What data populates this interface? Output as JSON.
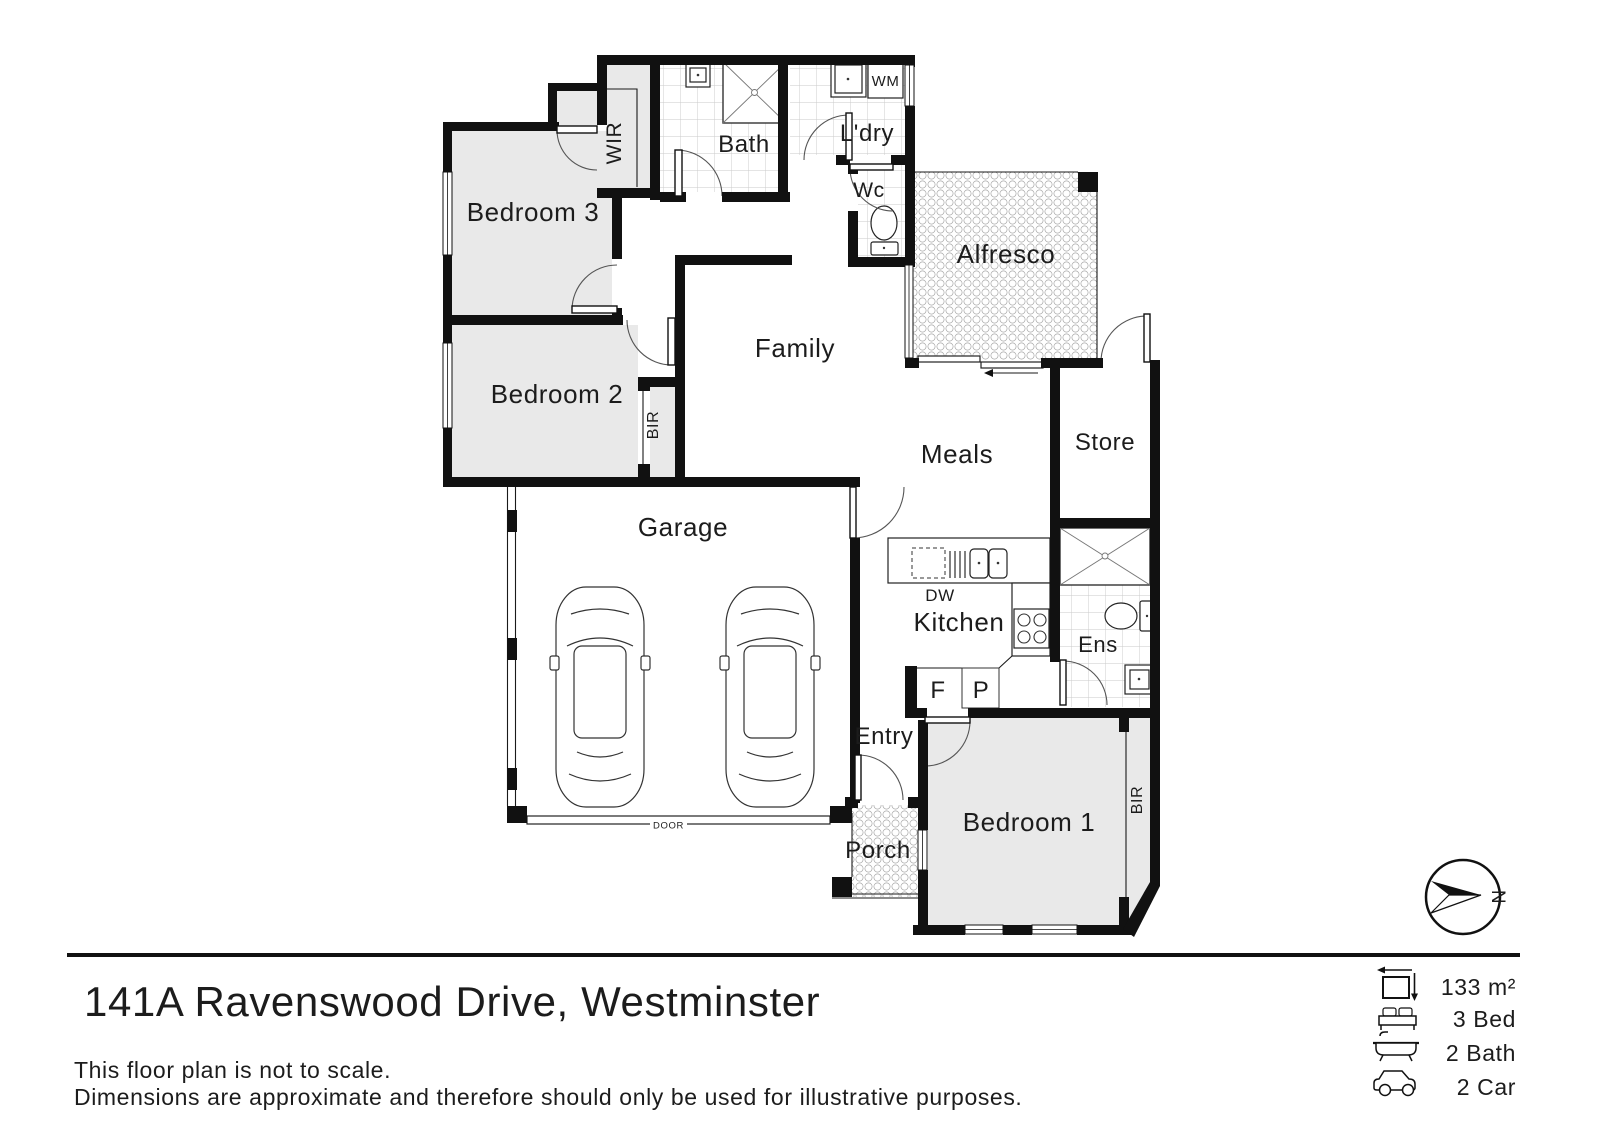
{
  "plan": {
    "rooms": {
      "bedroom3": "Bedroom 3",
      "bedroom2": "Bedroom 2",
      "bedroom1": "Bedroom 1",
      "wir": "WIR",
      "bath": "Bath",
      "laundry": "L'dry",
      "wc": "Wc",
      "alfresco": "Alfresco",
      "family": "Family",
      "meals": "Meals",
      "store": "Store",
      "garage": "Garage",
      "kitchen": "Kitchen",
      "ensuite": "Ens",
      "entry": "Entry",
      "porch": "Porch",
      "bir_bedroom2": "BIR",
      "bir_bedroom1": "BIR"
    },
    "fixtures": {
      "washing_machine": "WM",
      "dishwasher": "DW",
      "fridge": "F",
      "pantry": "P",
      "garage_door": "DOOR"
    },
    "compass_north": "N"
  },
  "footer": {
    "address": "141A Ravenswood Drive, Westminster",
    "disclaimer_line1": "This floor plan is not to scale.",
    "disclaimer_line2": "Dimensions are approximate and therefore should only be used for illustrative purposes.",
    "stats": [
      {
        "icon": "floor-area-icon",
        "value": "133 m²"
      },
      {
        "icon": "bed-icon",
        "value": "3 Bed"
      },
      {
        "icon": "bath-icon",
        "value": "2 Bath"
      },
      {
        "icon": "car-icon",
        "value": "2 Car"
      }
    ]
  }
}
